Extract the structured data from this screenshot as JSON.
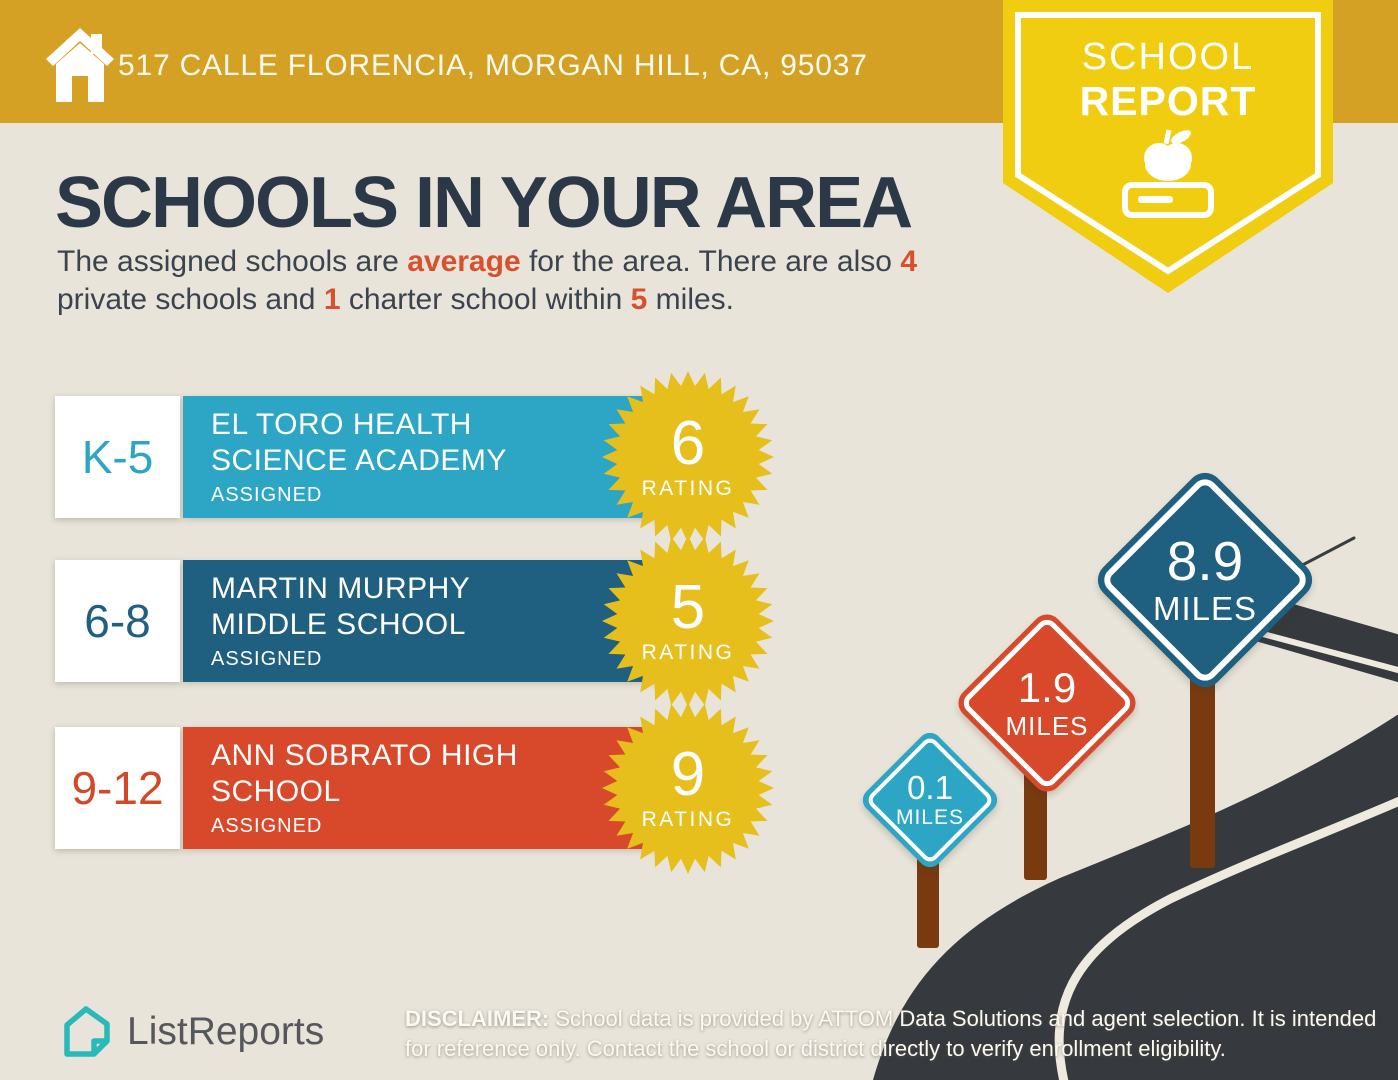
{
  "header": {
    "address": "517 CALLE FLORENCIA, MORGAN HILL, CA, 95037"
  },
  "ribbon": {
    "line1": "SCHOOL",
    "line2": "REPORT"
  },
  "intro": {
    "title": "SCHOOLS IN YOUR AREA",
    "subtitle": {
      "s1": "The assigned schools are ",
      "a1": "average",
      "s2": " for the area. There are also ",
      "a2": "4",
      "s3": "private schools and ",
      "a3": "1",
      "s4": " charter school within ",
      "a4": "5",
      "s5": " miles."
    }
  },
  "schools": [
    {
      "grades": "K-5",
      "name": "EL TORO HEALTH SCIENCE ACADEMY",
      "name_line1": "EL TORO HEALTH",
      "name_line2": "SCIENCE ACADEMY",
      "status": "ASSIGNED",
      "rating": "6",
      "rating_label": "RATING",
      "distance_miles": "0.1",
      "color": "#2CA6C4"
    },
    {
      "grades": "6-8",
      "name": "MARTIN MURPHY MIDDLE SCHOOL",
      "name_line1": "MARTIN MURPHY",
      "name_line2": "MIDDLE SCHOOL",
      "status": "ASSIGNED",
      "rating": "5",
      "rating_label": "RATING",
      "distance_miles": "1.9",
      "color": "#1F5F80"
    },
    {
      "grades": "9-12",
      "name": "ANN SOBRATO HIGH SCHOOL",
      "name_line1": "ANN SOBRATO HIGH",
      "name_line2": "SCHOOL",
      "status": "ASSIGNED",
      "rating": "9",
      "rating_label": "RATING",
      "distance_miles": "8.9",
      "color": "#D8492B"
    }
  ],
  "distance_signs": [
    {
      "value": "0.1",
      "label": "MILES",
      "color": "#2CA6C4"
    },
    {
      "value": "1.9",
      "label": "MILES",
      "color": "#D8492B"
    },
    {
      "value": "8.9",
      "label": "MILES",
      "color": "#1F5F80"
    }
  ],
  "footer": {
    "brand": "ListReports",
    "disclaimer_label": "DISCLAIMER:",
    "disclaimer_line1": " School data is provided by ATTOM Data Solutions and agent selection. It is intended",
    "disclaimer_line2": "for reference only. Contact the school or district directly to verify enrollment eligibility."
  },
  "colors": {
    "header_gold": "#D4A124",
    "ribbon_yellow": "#F1CD12",
    "rating_badge_gold": "#E7BF1D",
    "title_navy": "#2B3847",
    "accent_orange": "#D8502C",
    "teal": "#2CA6C4",
    "dark_blue": "#1F5F80",
    "red": "#D8492B",
    "road_dark": "#36393D",
    "road_line_cream": "#EFEADE",
    "post_brown": "#7A3A0F",
    "background": "#E9E4D9",
    "logo_teal": "#29B9B9"
  }
}
